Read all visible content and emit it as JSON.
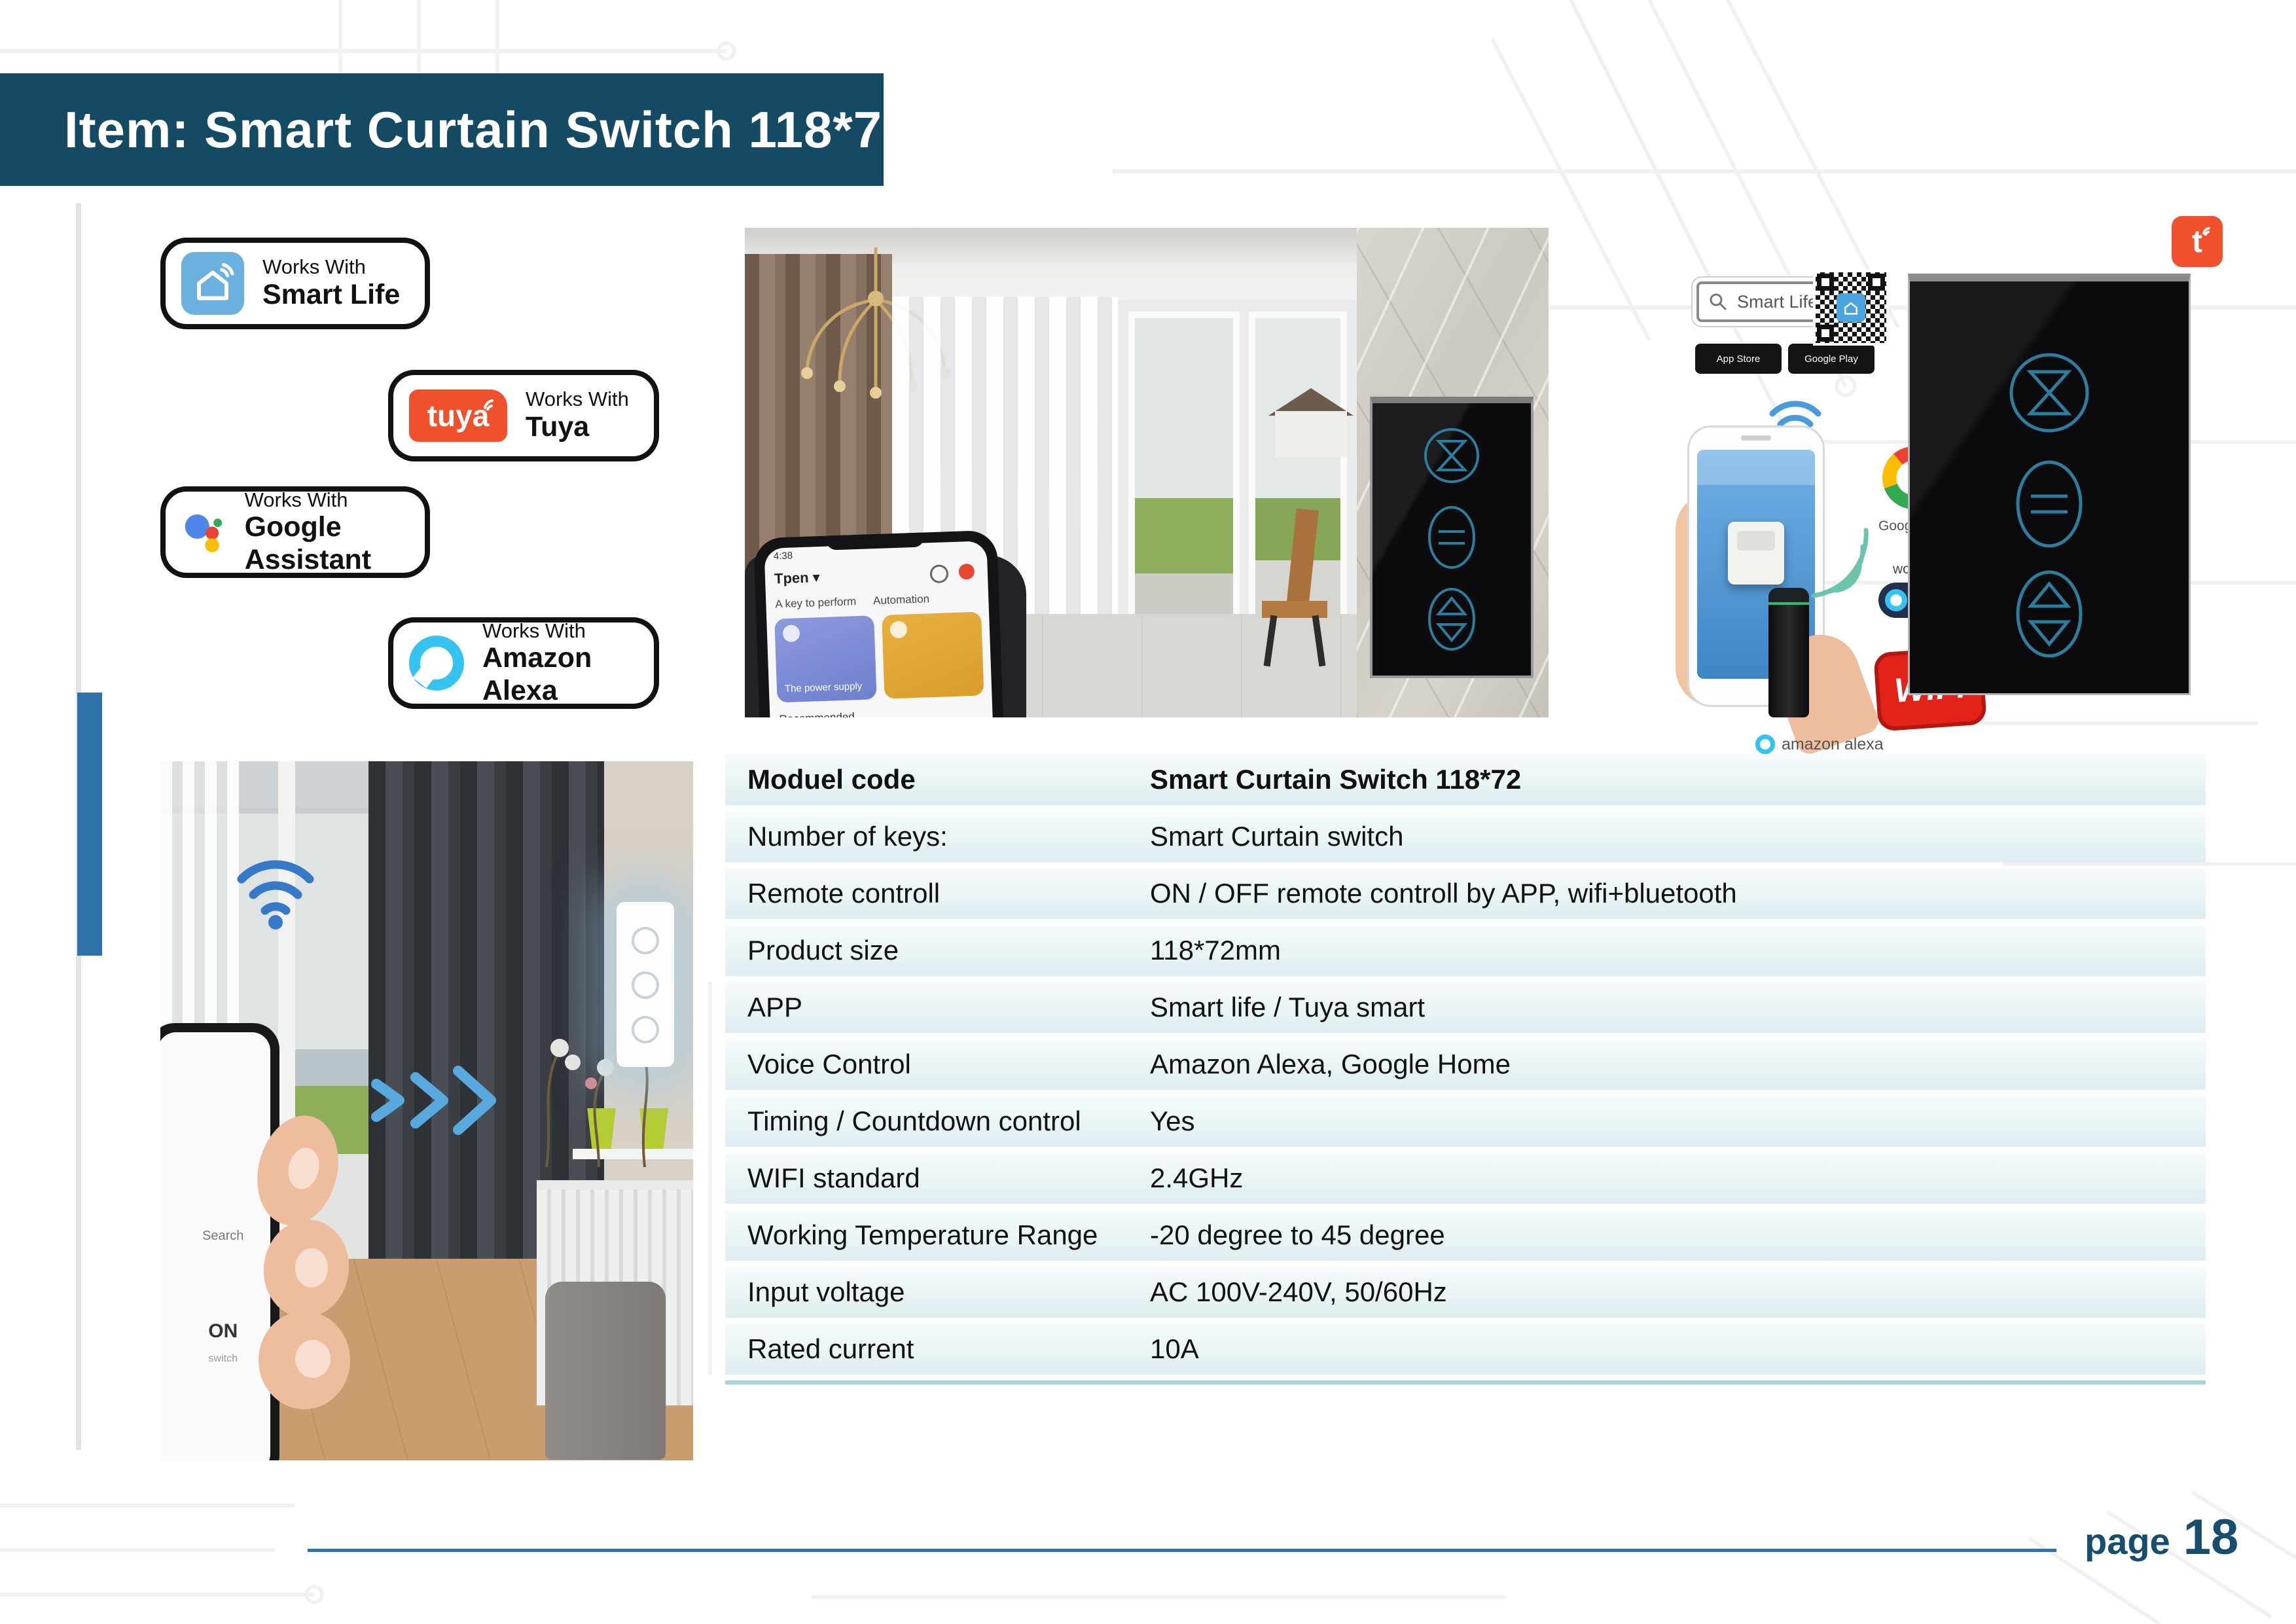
{
  "header": {
    "title": "Item: Smart Curtain Switch 118*72"
  },
  "footer": {
    "page_label": "page",
    "page_number": "18"
  },
  "badges": [
    {
      "line1": "Works With",
      "line2": "Smart Life"
    },
    {
      "line1": "Works With",
      "line2": "Tuya",
      "logo": "tuya"
    },
    {
      "line1": "Works With",
      "line2": "Google Assistant"
    },
    {
      "line1": "Works With",
      "line2": "Amazon Alexa"
    }
  ],
  "spec_table": {
    "rows": [
      {
        "label": "Moduel code",
        "value": "Smart Curtain Switch 118*72"
      },
      {
        "label": "Number of keys:",
        "value": "Smart Curtain switch"
      },
      {
        "label": "Remote controll",
        "value": "ON / OFF remote controll by APP, wifi+bluetooth"
      },
      {
        "label": "Product size",
        "value": "118*72mm"
      },
      {
        "label": "APP",
        "value": "Smart life / Tuya smart"
      },
      {
        "label": "Voice Control",
        "value": "Amazon Alexa, Google Home"
      },
      {
        "label": "Timing / Countdown control",
        "value": "Yes"
      },
      {
        "label": "WIFI standard",
        "value": "2.4GHz"
      },
      {
        "label": "Working Temperature Range",
        "value": "-20 degree to 45 degree"
      },
      {
        "label": "Input voltage",
        "value": "AC 100V-240V, 50/60Hz"
      },
      {
        "label": "Rated current",
        "value": "10A"
      }
    ]
  },
  "right_panel": {
    "tuya_logo": "t",
    "search_text": "Smart Life",
    "app_store": "App Store",
    "google_play": "Google Play",
    "google_home": "Google Home",
    "work_with": "work with",
    "alexa": "Alexa",
    "wifi_logo": "WiFi",
    "amazon_alexa": "amazon alexa"
  },
  "main_photo": {
    "app": {
      "time": "4:38",
      "home": "Tpen ▾",
      "tab1": "A key to perform",
      "tab2": "Automation",
      "card1": "The power supply",
      "section": "Recommended"
    }
  },
  "left_photo": {
    "phone_search": "Search",
    "phone_label": "ON",
    "phone_sub": "switch"
  },
  "colors": {
    "header_bg": "#154a64",
    "accent_blue": "#2d72a8",
    "table_row": "#e9f4f6",
    "tuya_orange": "#f0502b",
    "alexa_cyan": "#35c3f2",
    "navy_text": "#174e70"
  }
}
